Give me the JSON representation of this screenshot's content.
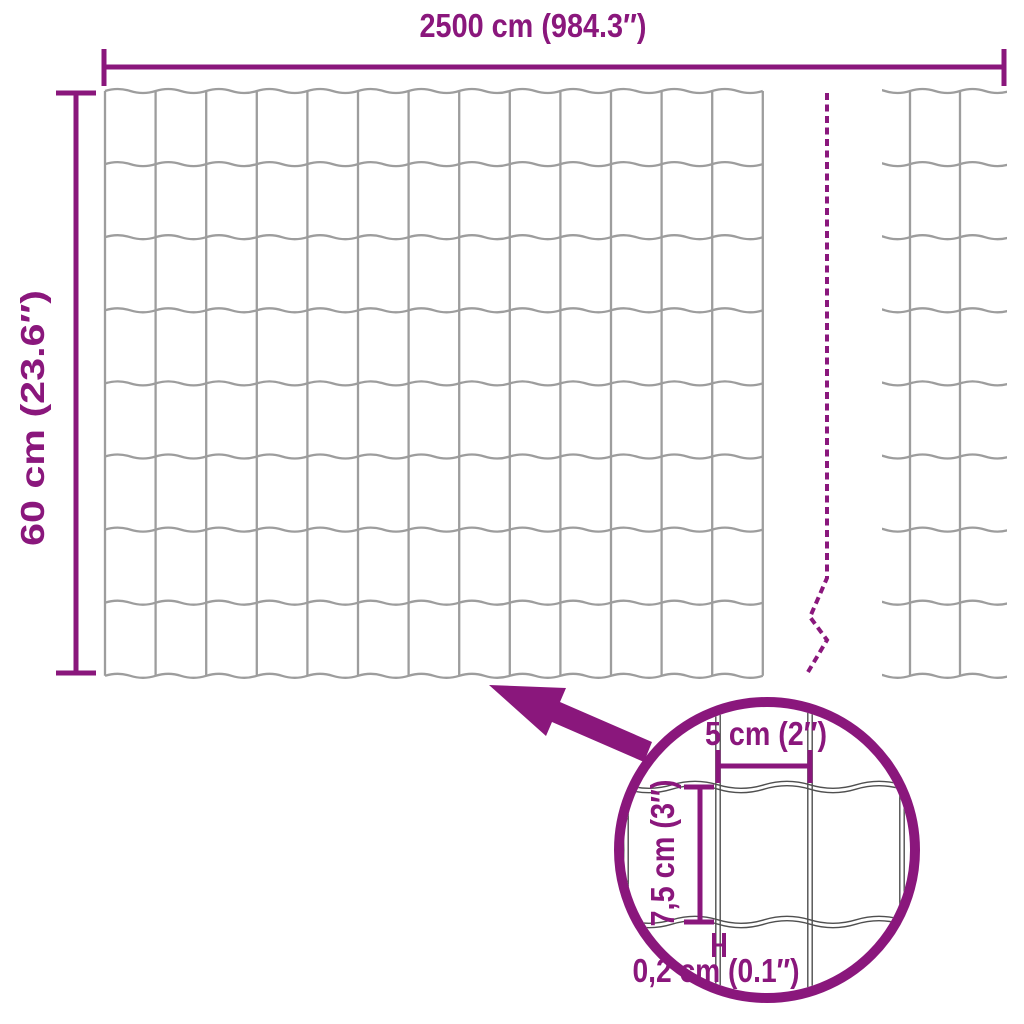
{
  "colors": {
    "accent": "#8A177C",
    "wire": "#9D9D9D",
    "wire_detail": "#4F4F4F",
    "background": "#FFFFFF"
  },
  "dimensions": {
    "total_width_label": "2500 cm (984.3″)",
    "total_height_label": "60 cm (23.6″)",
    "mesh_opening_width_label": "5 cm (2″)",
    "mesh_opening_height_label": "7,5 cm (3″)",
    "wire_thickness_label": "0,2 cm (0.1″)"
  }
}
